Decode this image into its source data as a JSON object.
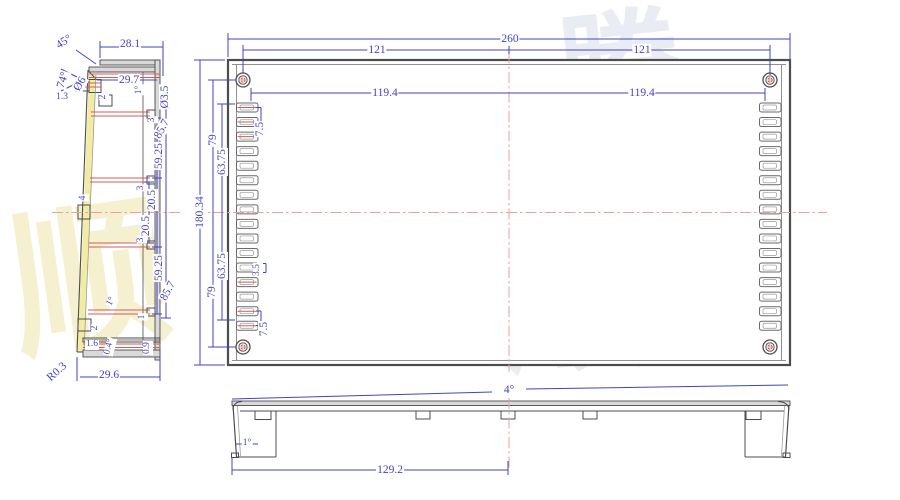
{
  "colors": {
    "dimension": "#4343c6",
    "centerline": "#eb9f9f",
    "outline": "#4d4d4d",
    "highlight_strip": "#f1eba6",
    "rib_red": "#cd5c5c"
  },
  "watermark": {
    "g0": "顺",
    "g1": "发",
    "g2": "顺",
    "g3": "达",
    "g4": "腾"
  },
  "side_view": {
    "dims": {
      "a45": "45°",
      "w28_1": "28.1",
      "w29_7": "29.7",
      "a74": "74°",
      "d6": "Ø6",
      "w1_3": "1.3",
      "t2_top": "2",
      "a1_top": "1°",
      "d3_5": "Ø3.5",
      "t3_top": "3",
      "h85_7_top": "85.7",
      "h59_25_top": "59.25",
      "t3_mid_top": "3",
      "h20_5_top": "20.5",
      "w4": "4",
      "h20_5_bot": "20.5",
      "t3_mid_bot": "3",
      "h59_25_bot": "59.25",
      "h85_7_bot": "85.7",
      "a1_bot": "1°",
      "h1": "1",
      "t2_bot": "2",
      "w1_6": "1.6",
      "a0_4": "0.4°",
      "h0_9": "0.9",
      "r0_3": "R0.3",
      "w29_6": "29.6"
    }
  },
  "top_view": {
    "fin_slots_per_side": 16,
    "screw_hole_count": 4,
    "dims": {
      "w260": "260",
      "w121_l": "121",
      "w121_r": "121",
      "w119_4_l": "119.4",
      "w119_4_r": "119.4",
      "h180_34": "180.34",
      "h79_top": "79",
      "h63_75_top": "63.75",
      "s7_5_top": "7.5",
      "s3_5": "3.5",
      "h63_75_bot": "63.75",
      "h79_bot": "79",
      "s7_5_bot": "7.5"
    }
  },
  "front_view": {
    "dims": {
      "a4": "4°",
      "a1": "1°",
      "w129_2": "129.2"
    }
  }
}
